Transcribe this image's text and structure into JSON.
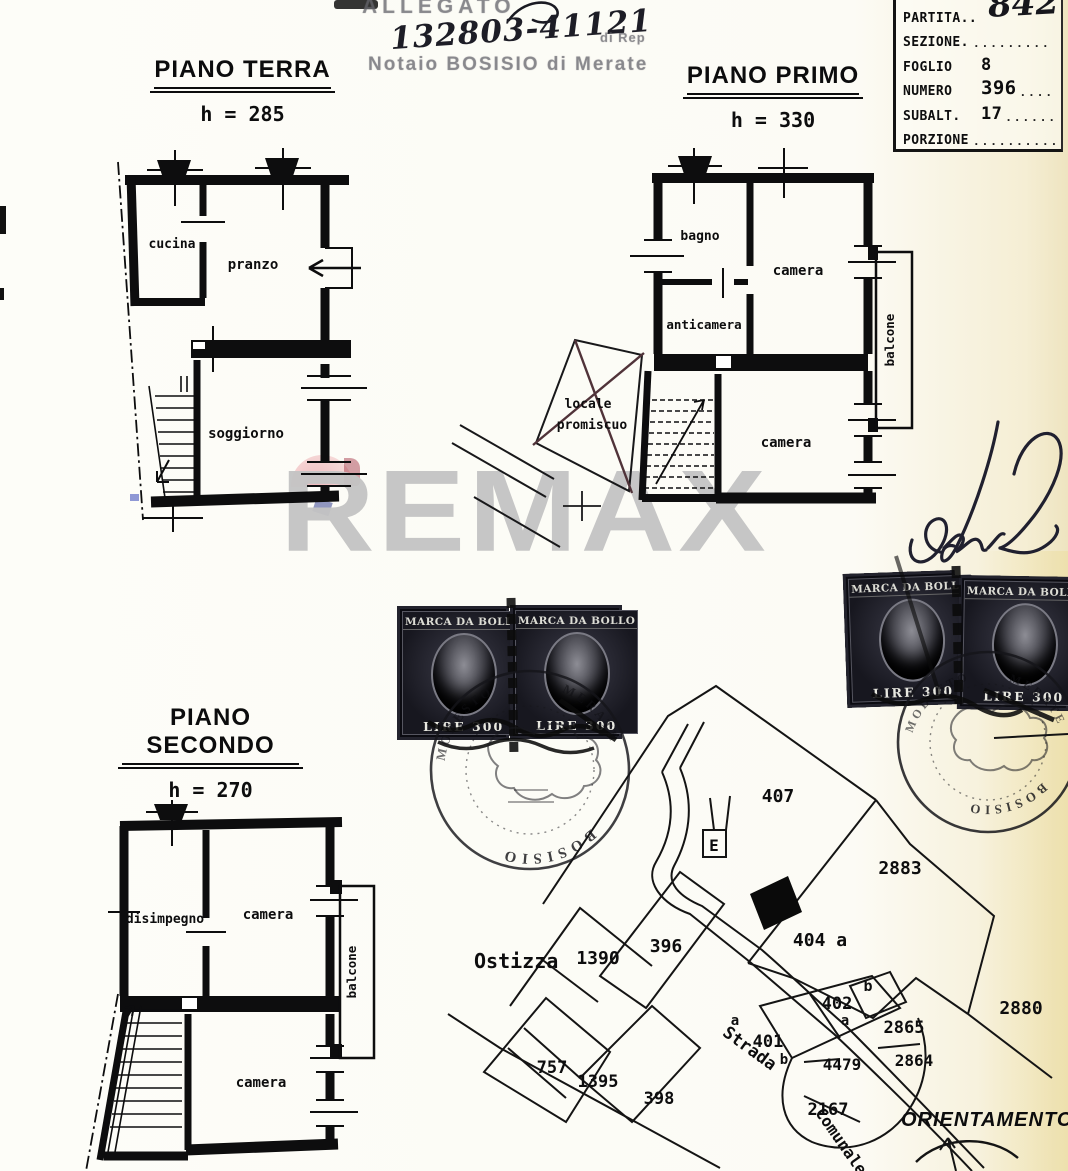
{
  "header": {
    "allegato_stamp": "ALLEGATO",
    "protocol_number": "132803-41121",
    "di_rep": "di Rep",
    "notary_stamp": "Notaio BOSISIO di Merate"
  },
  "cadastral_table": {
    "rows": [
      {
        "label": "PARTITA..",
        "value": "842",
        "dots": ""
      },
      {
        "label": "SEZIONE.",
        "value": "",
        "dots": "........."
      },
      {
        "label": "FOGLIO",
        "value": "8",
        "dots": ""
      },
      {
        "label": "NUMERO",
        "value": "396",
        "dots": "...."
      },
      {
        "label": "SUBALT.",
        "value": "17",
        "dots": "......."
      },
      {
        "label": "PORZIONE",
        "value": "",
        "dots": "................."
      }
    ]
  },
  "floor_terra": {
    "title": "PIANO TERRA",
    "height": "h = 285",
    "rooms": {
      "cucina": "cucina",
      "pranzo": "pranzo",
      "soggiorno": "soggiorno"
    }
  },
  "floor_primo": {
    "title": "PIANO PRIMO",
    "height": "h = 330",
    "rooms": {
      "bagno": "bagno",
      "camera_top": "camera",
      "anticamera": "anticamera",
      "camera_bottom": "camera",
      "balcone": "balcone"
    },
    "annex": {
      "line1": "locale",
      "line2": "promiscuo"
    }
  },
  "floor_secondo": {
    "title": "PIANO SECONDO",
    "height": "h = 270",
    "rooms": {
      "disimpegno": "disimpegno",
      "camera_top": "camera",
      "camera_bottom": "camera",
      "balcone": "balcone"
    }
  },
  "watermark": {
    "text": "REMAX"
  },
  "stamps": {
    "marca_title": "MARCA DA BOLLO",
    "marca_value": "LIRE 300",
    "round_name": "BOSISIO",
    "round_name2": "MODESTO",
    "round_city": "MERATE"
  },
  "map": {
    "place": "Ostizza",
    "marker": "E",
    "road_word1": "Strada",
    "road_word2": "Comunale",
    "orientation": "ORIENTAMENTO",
    "labels": {
      "p407": "407",
      "p2883": "2883",
      "p1390": "1390",
      "p396": "396",
      "p404": "404 a",
      "p404b": "b",
      "p402": "402",
      "p402a": "a",
      "p401a": "a",
      "p401": "401",
      "p401b": "b",
      "p2880": "2880",
      "p2865": "2865",
      "p2864": "2864",
      "p4479": "4479",
      "p2167": "2167",
      "p757": "757",
      "p1395": "1395",
      "p398": "398"
    }
  }
}
